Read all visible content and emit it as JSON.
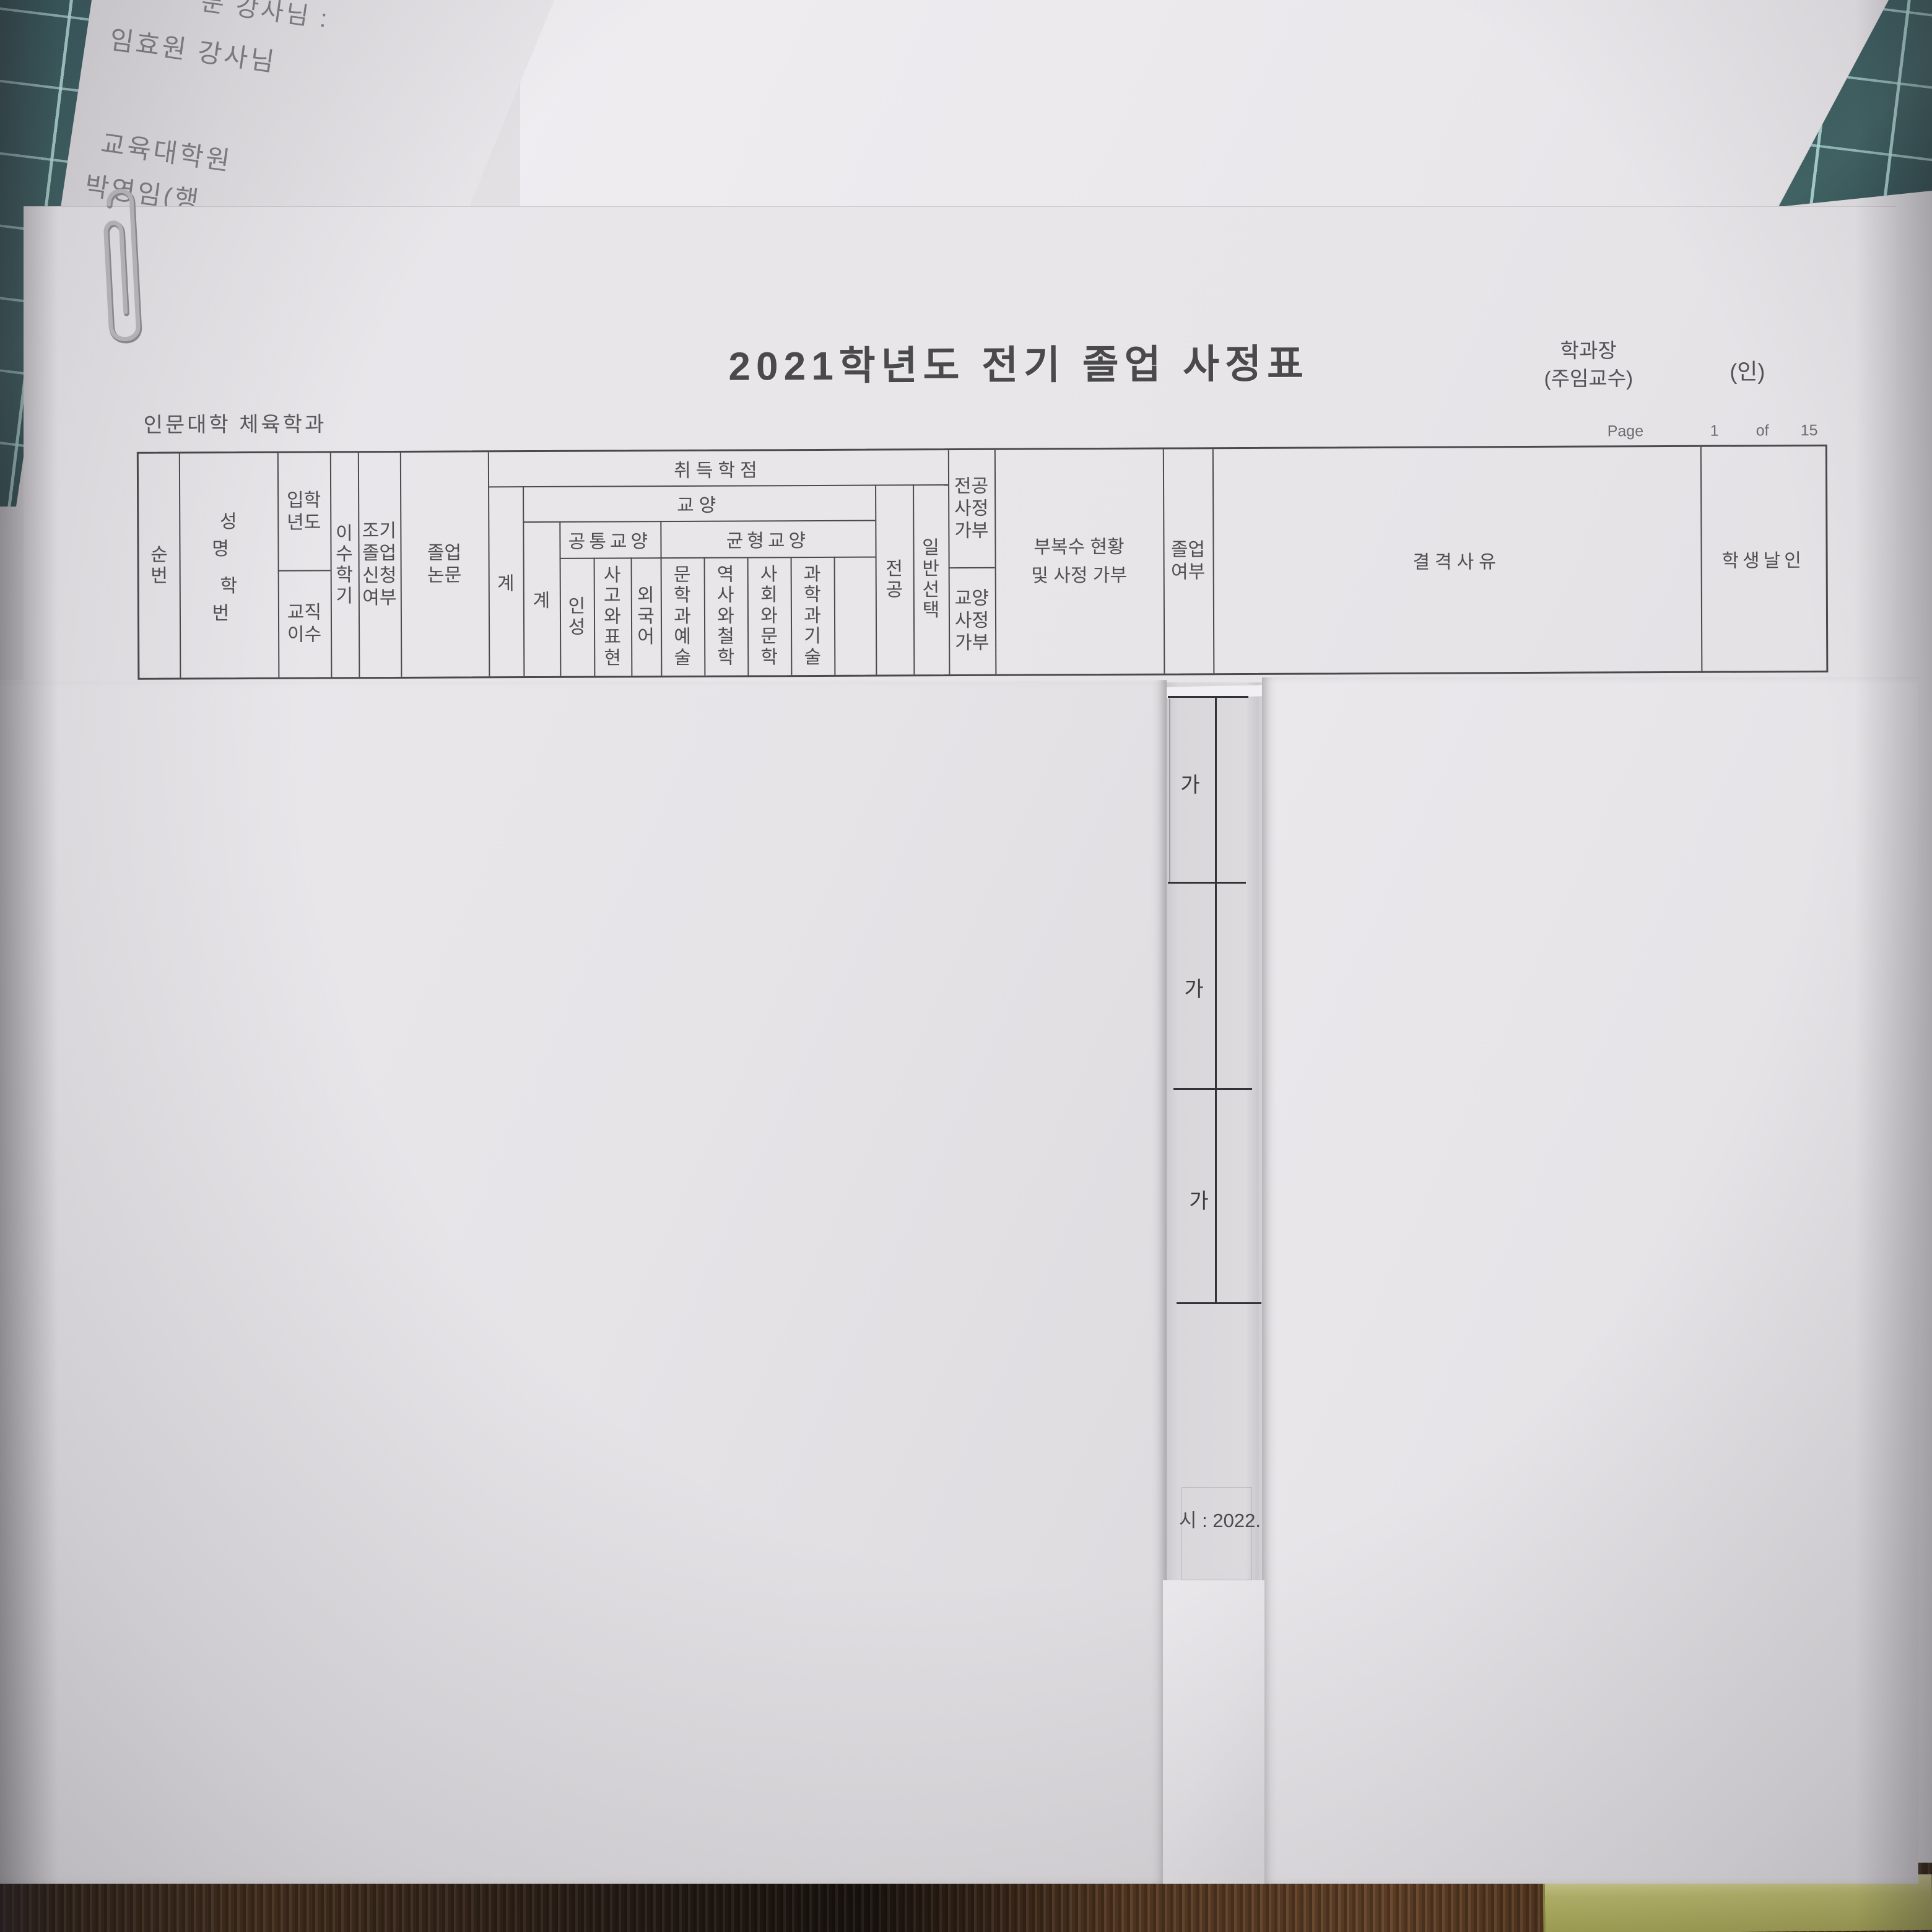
{
  "background": {
    "note_paper": {
      "line1": "분 강사님 :",
      "line2": "임효원 강사님",
      "line3": "교육대학원",
      "line4": "박영임(행"
    }
  },
  "document": {
    "title": "2021학년도 전기 졸업 사정표",
    "approver_line1": "학과장",
    "approver_line2": "(주임교수)",
    "seal_placeholder": "(인)",
    "department": "인문대학 체육학과",
    "page": {
      "label": "Page",
      "number": "1",
      "of_label": "of",
      "total": "15"
    },
    "table": {
      "no": "순번",
      "name_line1": "성 명",
      "name_line2": "학 번",
      "admission_year": "입학년도",
      "teaching_cert": "교직이수",
      "semesters": "이수학기",
      "early_grad": "조기졸업신청여부",
      "thesis": "졸업논문",
      "earned_credits": {
        "title": "취득학점",
        "total": "계",
        "liberal_arts": {
          "title": "교양",
          "total": "계",
          "common": {
            "title": "공통교양",
            "columns": [
              "인성",
              "사고와표현",
              "외국어"
            ]
          },
          "balanced": {
            "title": "균형교양",
            "columns": [
              "문학과예술",
              "역사와철학",
              "사회와문학",
              "과학과기술"
            ]
          }
        },
        "major": "전공",
        "general_elective": "일반선택"
      },
      "major_assessment": "전공사정가부",
      "liberal_assessment": "교양사정가부",
      "minor_double_line1": "부복수 현황",
      "minor_double_line2": "및 사정 가부",
      "graduation": "졸업여부",
      "disqualification_reason": "결격사유",
      "student_seal": "학생날인"
    }
  },
  "underlying_sheet": {
    "graduation_marks": [
      "가",
      "가",
      "가"
    ],
    "partial_date_text": "시 : 2022."
  },
  "colors": {
    "mat": "#3e6061",
    "mat_grid": "#b9e1de",
    "paper": "#e8e6e9",
    "line": "#4b494c",
    "wood": "#52351d",
    "book": "#b2b259"
  }
}
